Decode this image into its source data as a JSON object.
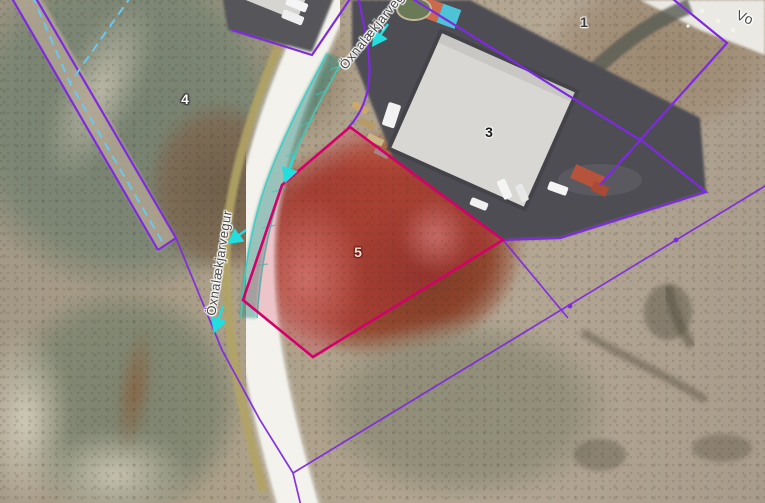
{
  "map": {
    "type": "aerial-parcel-map",
    "road_labels": [
      {
        "id": "road-west",
        "text": "Öxnalækjarvegur"
      },
      {
        "id": "road-top",
        "text": "Öxnalækjarvegur"
      },
      {
        "id": "road-right",
        "text": "Vo"
      }
    ],
    "parcels": [
      {
        "number": "1",
        "highlighted": false
      },
      {
        "number": "3",
        "highlighted": false
      },
      {
        "number": "4",
        "highlighted": false
      },
      {
        "number": "5",
        "highlighted": true
      }
    ],
    "colors": {
      "parcel_boundary": "#7d2ae0",
      "highlight_boundary": "#d4006a",
      "highlight_fill": "rgba(220,30,70,0.22)",
      "channel": "#35cfc4",
      "flow_arrow": "#22dede",
      "guide_dashed": "#6cc6ee"
    }
  }
}
